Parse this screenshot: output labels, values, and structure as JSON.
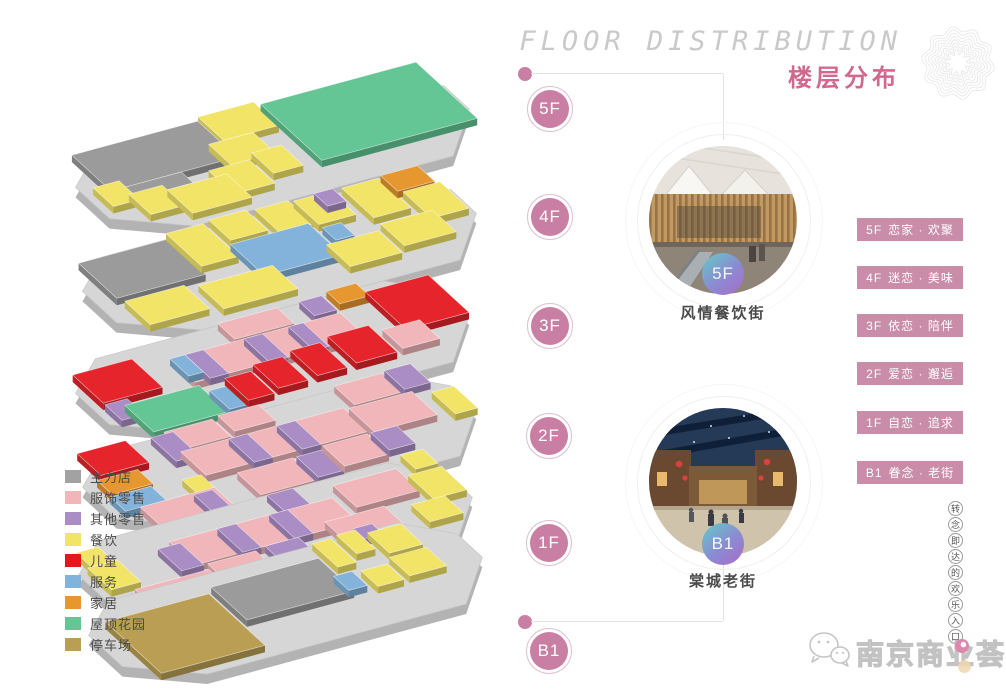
{
  "header": {
    "title_en": "FLOOR DISTRIBUTION",
    "title_zh": "楼层分布"
  },
  "floor_markers": [
    {
      "label": "5F"
    },
    {
      "label": "4F"
    },
    {
      "label": "3F"
    },
    {
      "label": "2F"
    },
    {
      "label": "1F"
    },
    {
      "label": "B1"
    }
  ],
  "features": [
    {
      "floor_badge": "5F",
      "caption": "风情餐饮街"
    },
    {
      "floor_badge": "B1",
      "caption": "棠城老街"
    }
  ],
  "floor_themes": [
    {
      "floor": "5F",
      "theme": "恋家 · 欢聚"
    },
    {
      "floor": "4F",
      "theme": "迷恋 · 美味"
    },
    {
      "floor": "3F",
      "theme": "依恋 · 陪伴"
    },
    {
      "floor": "2F",
      "theme": "爱恋 · 邂逅"
    },
    {
      "floor": "1F",
      "theme": "自恋 · 追求"
    },
    {
      "floor": "B1",
      "theme": "眷念 · 老街"
    }
  ],
  "legend": {
    "items": [
      {
        "label": "主力店",
        "color": "#a2a2a2"
      },
      {
        "label": "服饰零售",
        "color": "#f0b6ba"
      },
      {
        "label": "其他零售",
        "color": "#ab8dc5"
      },
      {
        "label": "餐饮",
        "color": "#f2e467"
      },
      {
        "label": "儿童",
        "color": "#e6161e"
      },
      {
        "label": "服务",
        "color": "#83b3da"
      },
      {
        "label": "家居",
        "color": "#e79730"
      },
      {
        "label": "屋顶花园",
        "color": "#64c694"
      },
      {
        "label": "停车场",
        "color": "#b99e53"
      }
    ]
  },
  "slogan_vertical": [
    "转",
    "念",
    "即",
    "达",
    "的",
    "欢",
    "乐",
    "入",
    "口"
  ],
  "logo": {
    "name": "南京商业荟"
  },
  "colors": {
    "accent_pink": "#c97ea4",
    "badge_pink": "#c98ca9",
    "title_pink": "#d2688e",
    "flower": "#e2e2e2",
    "marker_ring": "#dfc0d2",
    "connector_line": "#e3e3e3"
  },
  "map3d": {
    "plate_top": "#d6d6d6",
    "plate_side": "#b3b3b3",
    "u": [
      370,
      -100
    ],
    "v": [
      85,
      78
    ],
    "outline": [
      [
        0,
        0.3
      ],
      [
        0.12,
        0.01
      ],
      [
        0.9,
        0.01
      ],
      [
        1,
        0.28
      ],
      [
        1,
        0.58
      ],
      [
        0.86,
        1
      ],
      [
        0.16,
        1
      ],
      [
        0,
        0.7
      ]
    ],
    "category_colors": {
      "anchor": "#9b9b9b",
      "fashion": "#f0b6ba",
      "other": "#ab8dc5",
      "food": "#f2e467",
      "kids": "#e6242b",
      "service": "#83b3da",
      "home": "#e79730",
      "roof": "#64c694",
      "parking": "#b99e53"
    },
    "floors": [
      {
        "label": "5F",
        "origin": [
          50,
          164
        ],
        "blocks": [
          {
            "c": "food",
            "s": 0.4,
            "t": 0.0,
            "w": 0.15,
            "d": 0.3
          },
          {
            "c": "anchor",
            "s": 0.05,
            "t": 0.04,
            "w": 0.34,
            "d": 0.46
          },
          {
            "c": "roof",
            "s": 0.56,
            "t": 0.04,
            "w": 0.42,
            "d": 0.72
          },
          {
            "c": "food",
            "s": 0.36,
            "t": 0.3,
            "w": 0.12,
            "d": 0.26
          },
          {
            "c": "anchor",
            "s": 0.06,
            "t": 0.5,
            "w": 0.18,
            "d": 0.14
          },
          {
            "c": "food",
            "s": 0.02,
            "t": 0.42,
            "w": 0.07,
            "d": 0.24
          },
          {
            "c": "food",
            "s": 0.3,
            "t": 0.56,
            "w": 0.11,
            "d": 0.3
          },
          {
            "c": "food",
            "s": 0.43,
            "t": 0.5,
            "w": 0.08,
            "d": 0.26
          },
          {
            "c": "food",
            "s": 0.08,
            "t": 0.58,
            "w": 0.09,
            "d": 0.26
          },
          {
            "c": "food",
            "s": 0.17,
            "t": 0.64,
            "w": 0.16,
            "d": 0.3
          }
        ]
      },
      {
        "label": "4F",
        "origin": [
          57,
          268
        ],
        "blocks": [
          {
            "c": "anchor",
            "s": 0.04,
            "t": 0.08,
            "w": 0.24,
            "d": 0.45
          },
          {
            "c": "food",
            "s": 0.29,
            "t": 0.02,
            "w": 0.1,
            "d": 0.42
          },
          {
            "c": "food",
            "s": 0.41,
            "t": 0.0,
            "w": 0.1,
            "d": 0.26
          },
          {
            "c": "food",
            "s": 0.53,
            "t": 0.02,
            "w": 0.09,
            "d": 0.3
          },
          {
            "c": "food",
            "s": 0.63,
            "t": 0.04,
            "w": 0.1,
            "d": 0.3
          },
          {
            "c": "other",
            "s": 0.69,
            "t": 0.02,
            "w": 0.05,
            "d": 0.16
          },
          {
            "c": "food",
            "s": 0.76,
            "t": 0.04,
            "w": 0.1,
            "d": 0.38
          },
          {
            "c": "home",
            "s": 0.87,
            "t": 0.02,
            "w": 0.1,
            "d": 0.2
          },
          {
            "c": "food",
            "s": 0.88,
            "t": 0.24,
            "w": 0.1,
            "d": 0.34
          },
          {
            "c": "service",
            "s": 0.4,
            "t": 0.3,
            "w": 0.21,
            "d": 0.4
          },
          {
            "c": "service",
            "s": 0.63,
            "t": 0.38,
            "w": 0.05,
            "d": 0.16
          },
          {
            "c": "food",
            "s": 0.05,
            "t": 0.58,
            "w": 0.16,
            "d": 0.3
          },
          {
            "c": "food",
            "s": 0.24,
            "t": 0.62,
            "w": 0.2,
            "d": 0.3
          },
          {
            "c": "food",
            "s": 0.6,
            "t": 0.56,
            "w": 0.14,
            "d": 0.28
          },
          {
            "c": "food",
            "s": 0.76,
            "t": 0.5,
            "w": 0.14,
            "d": 0.28
          }
        ]
      },
      {
        "label": "3F",
        "origin": [
          50,
          370
        ],
        "blocks": [
          {
            "c": "fashion",
            "s": 0.44,
            "t": 0.06,
            "w": 0.16,
            "d": 0.2
          },
          {
            "c": "home",
            "s": 0.74,
            "t": 0.03,
            "w": 0.08,
            "d": 0.16
          },
          {
            "c": "other",
            "s": 0.66,
            "t": 0.06,
            "w": 0.06,
            "d": 0.18
          },
          {
            "c": "kids",
            "s": 0.02,
            "t": 0.18,
            "w": 0.16,
            "d": 0.36
          },
          {
            "c": "kids",
            "s": 0.82,
            "t": 0.14,
            "w": 0.17,
            "d": 0.48
          },
          {
            "c": "fashion",
            "s": 0.26,
            "t": 0.28,
            "w": 0.46,
            "d": 0.3
          },
          {
            "c": "other",
            "s": 0.3,
            "t": 0.28,
            "w": 0.05,
            "d": 0.3
          },
          {
            "c": "other",
            "s": 0.46,
            "t": 0.28,
            "w": 0.05,
            "d": 0.3
          },
          {
            "c": "other",
            "s": 0.58,
            "t": 0.28,
            "w": 0.04,
            "d": 0.3
          },
          {
            "c": "service",
            "s": 0.26,
            "t": 0.28,
            "w": 0.04,
            "d": 0.22
          },
          {
            "c": "other",
            "s": 0.02,
            "t": 0.56,
            "w": 0.06,
            "d": 0.2
          },
          {
            "c": "roof",
            "s": 0.06,
            "t": 0.62,
            "w": 0.2,
            "d": 0.34
          },
          {
            "c": "service",
            "s": 0.27,
            "t": 0.7,
            "w": 0.05,
            "d": 0.24
          },
          {
            "c": "kids",
            "s": 0.33,
            "t": 0.62,
            "w": 0.07,
            "d": 0.28
          },
          {
            "c": "kids",
            "s": 0.42,
            "t": 0.56,
            "w": 0.08,
            "d": 0.3
          },
          {
            "c": "kids",
            "s": 0.53,
            "t": 0.52,
            "w": 0.08,
            "d": 0.32
          },
          {
            "c": "kids",
            "s": 0.64,
            "t": 0.48,
            "w": 0.11,
            "d": 0.34
          },
          {
            "c": "fashion",
            "s": 0.77,
            "t": 0.56,
            "w": 0.1,
            "d": 0.24
          }
        ]
      },
      {
        "label": "2F",
        "origin": [
          57,
          464
        ],
        "blocks": [
          {
            "c": "kids",
            "s": 0.05,
            "t": 0.02,
            "w": 0.13,
            "d": 0.28
          },
          {
            "c": "fashion",
            "s": 0.28,
            "t": 0.04,
            "w": 0.13,
            "d": 0.22
          },
          {
            "c": "other",
            "s": 0.24,
            "t": 0.06,
            "w": 0.06,
            "d": 0.3
          },
          {
            "c": "fashion",
            "s": 0.43,
            "t": 0.02,
            "w": 0.11,
            "d": 0.2
          },
          {
            "c": "fashion",
            "s": 0.74,
            "t": 0.04,
            "w": 0.13,
            "d": 0.24
          },
          {
            "c": "other",
            "s": 0.88,
            "t": 0.02,
            "w": 0.07,
            "d": 0.24
          },
          {
            "c": "home",
            "s": 0.03,
            "t": 0.34,
            "w": 0.11,
            "d": 0.18
          },
          {
            "c": "fashion",
            "s": 0.27,
            "t": 0.28,
            "w": 0.44,
            "d": 0.3
          },
          {
            "c": "other",
            "s": 0.4,
            "t": 0.28,
            "w": 0.05,
            "d": 0.3
          },
          {
            "c": "other",
            "s": 0.53,
            "t": 0.28,
            "w": 0.05,
            "d": 0.3
          },
          {
            "c": "fashion",
            "s": 0.72,
            "t": 0.3,
            "w": 0.17,
            "d": 0.3
          },
          {
            "c": "food",
            "s": 0.93,
            "t": 0.36,
            "w": 0.06,
            "d": 0.28
          },
          {
            "c": "service",
            "s": 0.02,
            "t": 0.54,
            "w": 0.11,
            "d": 0.18
          },
          {
            "c": "food",
            "s": 0.21,
            "t": 0.56,
            "w": 0.05,
            "d": 0.18
          },
          {
            "c": "fashion",
            "s": 0.34,
            "t": 0.64,
            "w": 0.15,
            "d": 0.28
          },
          {
            "c": "other",
            "s": 0.5,
            "t": 0.64,
            "w": 0.07,
            "d": 0.26
          },
          {
            "c": "fashion",
            "s": 0.58,
            "t": 0.6,
            "w": 0.12,
            "d": 0.26
          },
          {
            "c": "other",
            "s": 0.71,
            "t": 0.6,
            "w": 0.07,
            "d": 0.22
          },
          {
            "c": "fashion",
            "s": 0.06,
            "t": 0.72,
            "w": 0.2,
            "d": 0.26
          },
          {
            "c": "other",
            "s": 0.2,
            "t": 0.74,
            "w": 0.05,
            "d": 0.2
          }
        ]
      },
      {
        "label": "1F",
        "origin": [
          53,
          552
        ],
        "blocks": [
          {
            "c": "food",
            "s": 0.03,
            "t": 0.14,
            "w": 0.06,
            "d": 0.18
          },
          {
            "c": "other",
            "s": 0.56,
            "t": 0.08,
            "w": 0.07,
            "d": 0.22
          },
          {
            "c": "fashion",
            "s": 0.72,
            "t": 0.16,
            "w": 0.17,
            "d": 0.28
          },
          {
            "c": "food",
            "s": 0.93,
            "t": 0.04,
            "w": 0.06,
            "d": 0.18
          },
          {
            "c": "food",
            "s": 0.9,
            "t": 0.26,
            "w": 0.09,
            "d": 0.3
          },
          {
            "c": "food",
            "s": 0.02,
            "t": 0.32,
            "w": 0.08,
            "d": 0.28
          },
          {
            "c": "fashion",
            "s": 0.25,
            "t": 0.28,
            "w": 0.44,
            "d": 0.3
          },
          {
            "c": "other",
            "s": 0.21,
            "t": 0.32,
            "w": 0.06,
            "d": 0.28
          },
          {
            "c": "other",
            "s": 0.38,
            "t": 0.28,
            "w": 0.05,
            "d": 0.3
          },
          {
            "c": "other",
            "s": 0.52,
            "t": 0.28,
            "w": 0.05,
            "d": 0.3
          },
          {
            "c": "fashion",
            "s": 0.62,
            "t": 0.5,
            "w": 0.16,
            "d": 0.26
          },
          {
            "c": "other",
            "s": 0.44,
            "t": 0.58,
            "w": 0.09,
            "d": 0.26
          },
          {
            "c": "fashion",
            "s": 0.28,
            "t": 0.6,
            "w": 0.13,
            "d": 0.26
          },
          {
            "c": "food",
            "s": 0.84,
            "t": 0.56,
            "w": 0.09,
            "d": 0.22
          },
          {
            "c": "fashion",
            "s": 0.07,
            "t": 0.66,
            "w": 0.2,
            "d": 0.28
          },
          {
            "c": "other",
            "s": 0.29,
            "t": 0.86,
            "w": 0.08,
            "d": 0.12
          }
        ]
      },
      {
        "label": "B1",
        "origin": [
          63,
          612
        ],
        "blocks": [
          {
            "c": "other",
            "s": 0.78,
            "t": 0.02,
            "w": 0.05,
            "d": 0.13
          },
          {
            "c": "food",
            "s": 0.66,
            "t": 0.06,
            "w": 0.05,
            "d": 0.3
          },
          {
            "c": "food",
            "s": 0.73,
            "t": 0.04,
            "w": 0.05,
            "d": 0.24
          },
          {
            "c": "food",
            "s": 0.8,
            "t": 0.1,
            "w": 0.09,
            "d": 0.26
          },
          {
            "c": "anchor",
            "s": 0.35,
            "t": 0.22,
            "w": 0.29,
            "d": 0.42
          },
          {
            "c": "parking",
            "s": 0.05,
            "t": 0.28,
            "w": 0.28,
            "d": 0.66
          },
          {
            "c": "service",
            "s": 0.63,
            "t": 0.44,
            "w": 0.05,
            "d": 0.18
          },
          {
            "c": "food",
            "s": 0.7,
            "t": 0.46,
            "w": 0.07,
            "d": 0.2
          },
          {
            "c": "food",
            "s": 0.79,
            "t": 0.4,
            "w": 0.1,
            "d": 0.24
          }
        ]
      }
    ]
  }
}
